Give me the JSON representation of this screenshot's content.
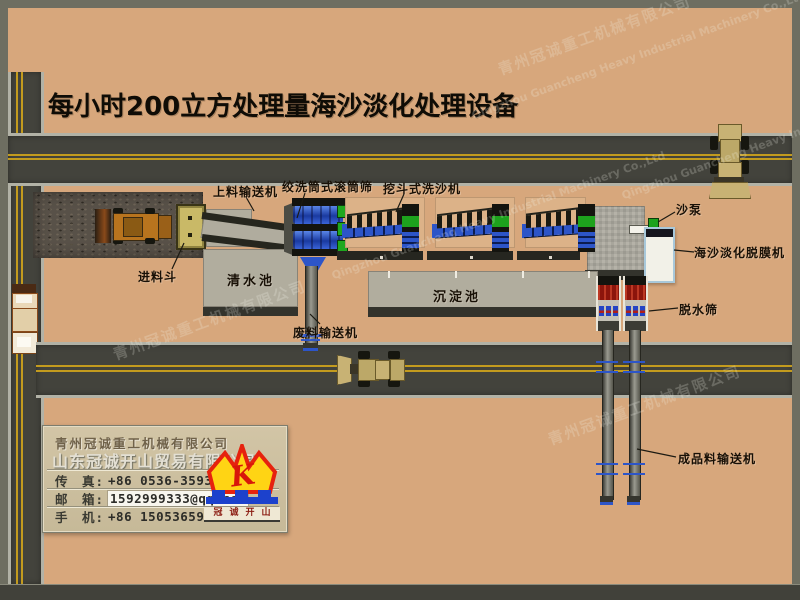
{
  "title": "每小时200立方处理量海沙淡化处理设备",
  "labels": {
    "feed_conveyor": "上料输送机",
    "drum_screen": "绞洗筒式滚筒筛",
    "bucket_washer": "挖斗式洗沙机",
    "sand_pump": "沙泵",
    "defilming_machine": "海沙淡化脱膜机",
    "dewatering_screen": "脱水筛",
    "feed_hopper": "进料斗",
    "clear_water_pool": "清水池",
    "sedimentation_pool": "沉淀池",
    "waste_conveyor": "废料输送机",
    "product_conveyor": "成品料输送机"
  },
  "company_card": {
    "company_machinery": "青州冠诚重工机械有限公司",
    "company_trade": "山东冠诚开山贸易有限公司",
    "fax_label": "传　真:",
    "fax_value": "+86 0536-3593111",
    "email_label": "邮　箱:",
    "email_value": "1592999333@qq.com",
    "mobile_label": "手　机:",
    "mobile_value": "+86 15053659999",
    "logo_letter": "K",
    "logo_caption": "冠诚开山"
  },
  "watermark": {
    "cn": "青州冠诚重工机械有限公司",
    "en": "Qingzhou Guancheng Heavy Industrial Machinery Co.,Ltd"
  },
  "colors": {
    "background_sand": "#d7a77c",
    "frame_gray": "#6e6e61",
    "road_asphalt": "#43433c",
    "road_line_yellow": "#c39b1e",
    "machine_blue": "#2d55c8",
    "machine_green": "#1da21d",
    "dewater_red": "#8c150c",
    "logo_yellow": "#ffd414",
    "logo_red": "#e6220e",
    "logo_blue": "#1c41cc"
  }
}
